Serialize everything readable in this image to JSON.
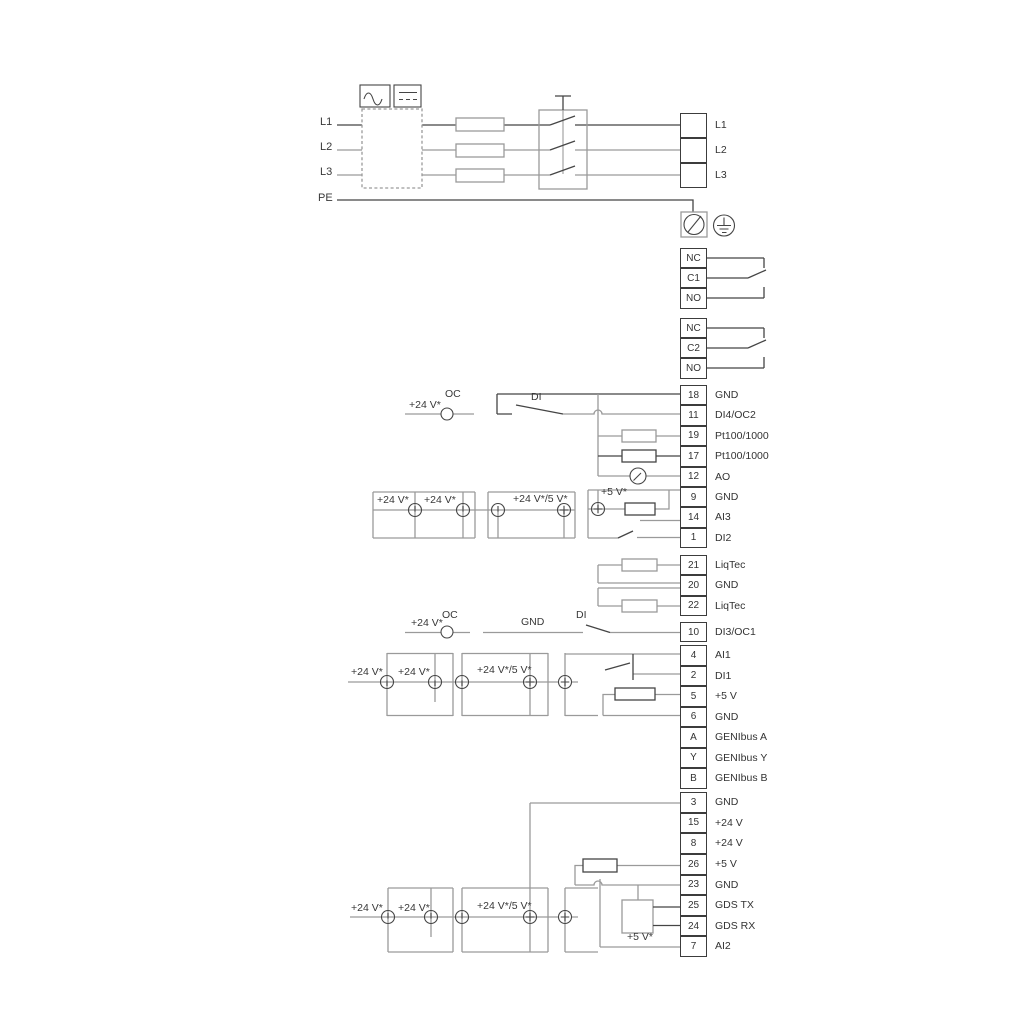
{
  "diagram": {
    "power_in": {
      "l1": "L1",
      "l2": "L2",
      "l3": "L3",
      "pe": "PE"
    },
    "strips": {
      "power_out": {
        "rows": [
          {
            "num": "",
            "label": "L1"
          },
          {
            "num": "",
            "label": "L2"
          },
          {
            "num": "",
            "label": "L3"
          }
        ]
      },
      "relay1": {
        "rows": [
          {
            "num": "NC",
            "label": ""
          },
          {
            "num": "C1",
            "label": ""
          },
          {
            "num": "NO",
            "label": ""
          }
        ]
      },
      "relay2": {
        "rows": [
          {
            "num": "NC",
            "label": ""
          },
          {
            "num": "C2",
            "label": ""
          },
          {
            "num": "NO",
            "label": ""
          }
        ]
      },
      "io1": {
        "rows": [
          {
            "num": "18",
            "label": "GND"
          },
          {
            "num": "11",
            "label": "DI4/OC2"
          },
          {
            "num": "19",
            "label": "Pt100/1000"
          },
          {
            "num": "17",
            "label": "Pt100/1000"
          },
          {
            "num": "12",
            "label": "AO"
          },
          {
            "num": "9",
            "label": "GND"
          },
          {
            "num": "14",
            "label": "AI3"
          },
          {
            "num": "1",
            "label": "DI2"
          }
        ]
      },
      "liqtec": {
        "rows": [
          {
            "num": "21",
            "label": "LiqTec"
          },
          {
            "num": "20",
            "label": "GND"
          },
          {
            "num": "22",
            "label": "LiqTec"
          }
        ]
      },
      "di3": {
        "rows": [
          {
            "num": "10",
            "label": "DI3/OC1"
          }
        ]
      },
      "ai1": {
        "rows": [
          {
            "num": "4",
            "label": "AI1"
          },
          {
            "num": "2",
            "label": "DI1"
          },
          {
            "num": "5",
            "label": "+5 V"
          },
          {
            "num": "6",
            "label": "GND"
          },
          {
            "num": "A",
            "label": "GENIbus A"
          },
          {
            "num": "Y",
            "label": "GENIbus Y"
          },
          {
            "num": "B",
            "label": "GENIbus B"
          }
        ]
      },
      "power_io": {
        "rows": [
          {
            "num": "3",
            "label": "GND"
          },
          {
            "num": "15",
            "label": "+24 V"
          },
          {
            "num": "8",
            "label": "+24 V"
          },
          {
            "num": "26",
            "label": "+5 V"
          },
          {
            "num": "23",
            "label": "GND"
          },
          {
            "num": "25",
            "label": "GDS TX"
          },
          {
            "num": "24",
            "label": "GDS RX"
          },
          {
            "num": "7",
            "label": "AI2"
          }
        ]
      }
    },
    "labels": {
      "s1_supply": "+24 V*",
      "s1_oc": "OC",
      "s1_di": "DI",
      "g1_supply1": "+24 V*",
      "g1_supply2": "+24 V*",
      "g1_supply3": "+24 V*/5 V*",
      "g1_supply4": "+5 V*",
      "g2_oc_supply": "+24 V*",
      "g2_oc": "OC",
      "g2_gnd": "GND",
      "g2_di": "DI",
      "g2_supply1": "+24 V*",
      "g2_supply2": "+24 V*",
      "g2_supply3": "+24 V*/5 V*",
      "g3_supply1": "+24 V*",
      "g3_supply2": "+24 V*",
      "g3_supply3": "+24 V*/5 V*",
      "g3_sensor_supply": "+5 V*"
    },
    "colors": {
      "wire_grey": "#9a9a9a",
      "wire_dark": "#454545",
      "text": "#383838"
    }
  }
}
